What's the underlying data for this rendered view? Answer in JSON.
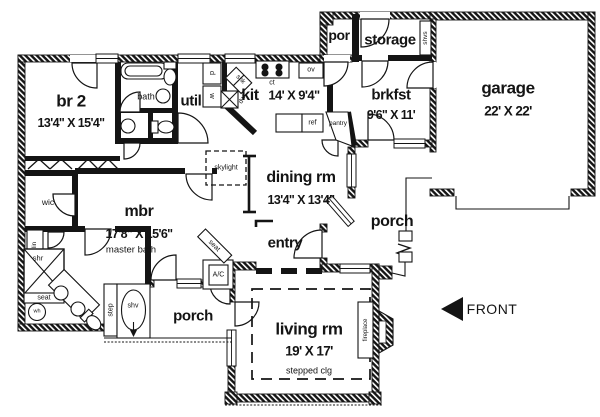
{
  "colors": {
    "line": "#141414",
    "background": "#ffffff"
  },
  "rooms": {
    "br2": {
      "name": "br 2",
      "dims": "13'4\" X 15'4\""
    },
    "bath": {
      "name": "bath"
    },
    "util": {
      "name": "util"
    },
    "kit": {
      "name": "kit",
      "dims": "14' X 9'4\""
    },
    "por": {
      "name": "por"
    },
    "storage": {
      "name": "storage"
    },
    "brkfst": {
      "name": "brkfst",
      "dims": "9'6\" X 11'"
    },
    "garage": {
      "name": "garage",
      "dims": "22' X 22'"
    },
    "dining": {
      "name": "dining rm",
      "dims": "13'4\" X 13'4\""
    },
    "entry": {
      "name": "entry"
    },
    "porch_right": {
      "name": "porch"
    },
    "porch_bottom": {
      "name": "porch"
    },
    "mbr": {
      "name": "mbr",
      "dims": "17'8\" X 15'6\""
    },
    "wic": {
      "name": "wic"
    },
    "master_bath": {
      "name": "master bath"
    },
    "living": {
      "name": "living rm",
      "dims": "19' X 17'",
      "ceiling": "stepped clg"
    }
  },
  "fixtures": {
    "dryer": "d",
    "washer": "w",
    "sink": "snk",
    "dishwasher": "dw",
    "cooktop": "ct",
    "oven": "ov",
    "fridge": "ref",
    "pantry": "pantry",
    "shelves": "shvs",
    "skylight": "skylight",
    "linen": "lin",
    "shower": "shr",
    "shower_seat": "seat",
    "water_heater": "wh",
    "step": "step",
    "tub_shelf": "shv",
    "ac_unit": "A/C",
    "hall_seat": "seat",
    "fireplace": "fireplace"
  },
  "annotations": {
    "front_arrow": "FRONT"
  }
}
